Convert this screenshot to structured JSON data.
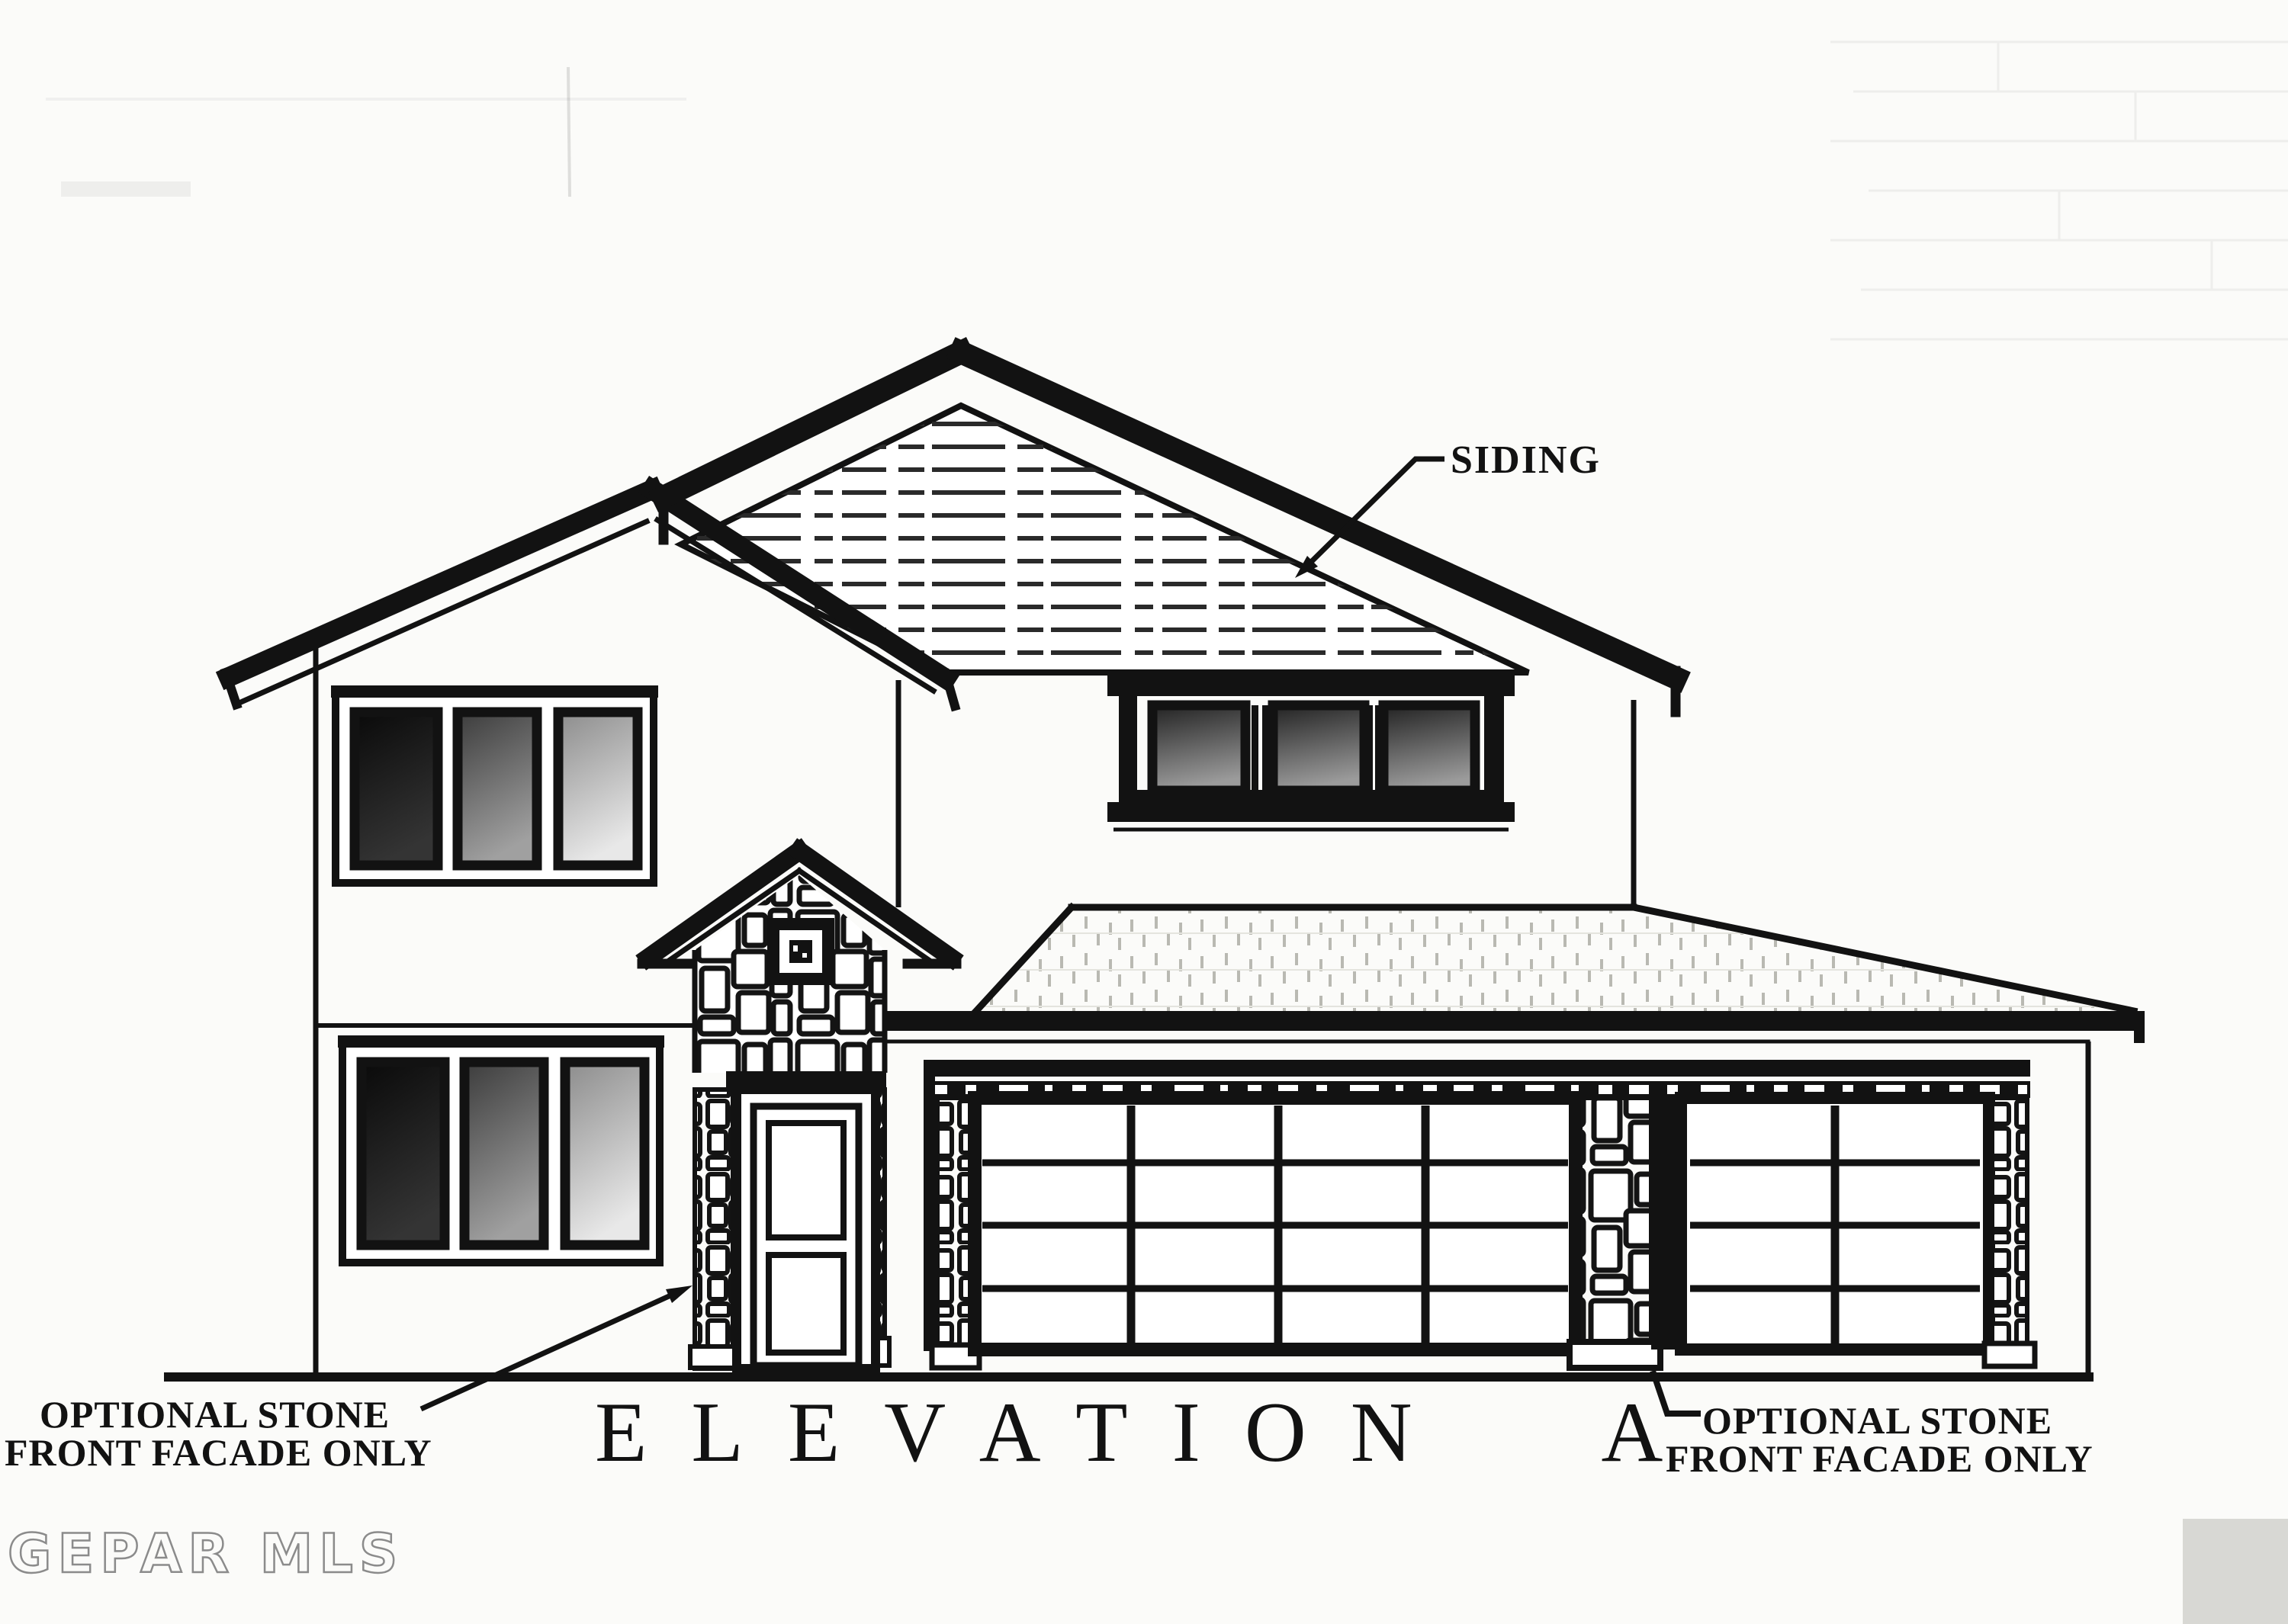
{
  "document": {
    "kind": "architectural elevation drawing (scanned)",
    "title": "ELEVATION A",
    "watermark": "GEPAR MLS",
    "annotations": {
      "siding": "SIDING",
      "left_note": [
        "OPTIONAL STONE",
        "FRONT FACADE ONLY"
      ],
      "right_note": [
        "OPTIONAL STONE",
        "FRONT FACADE ONLY"
      ]
    },
    "colors": {
      "ink": "#121212",
      "paper": "#fbfbf9",
      "glass_dark": "#0e0e0e",
      "glass_mid": "#8f8f8f",
      "glass_light": "#e4e4e4",
      "watermark_stroke": "#8b8b8b",
      "scan_artifact": "#d8d8d4"
    }
  }
}
